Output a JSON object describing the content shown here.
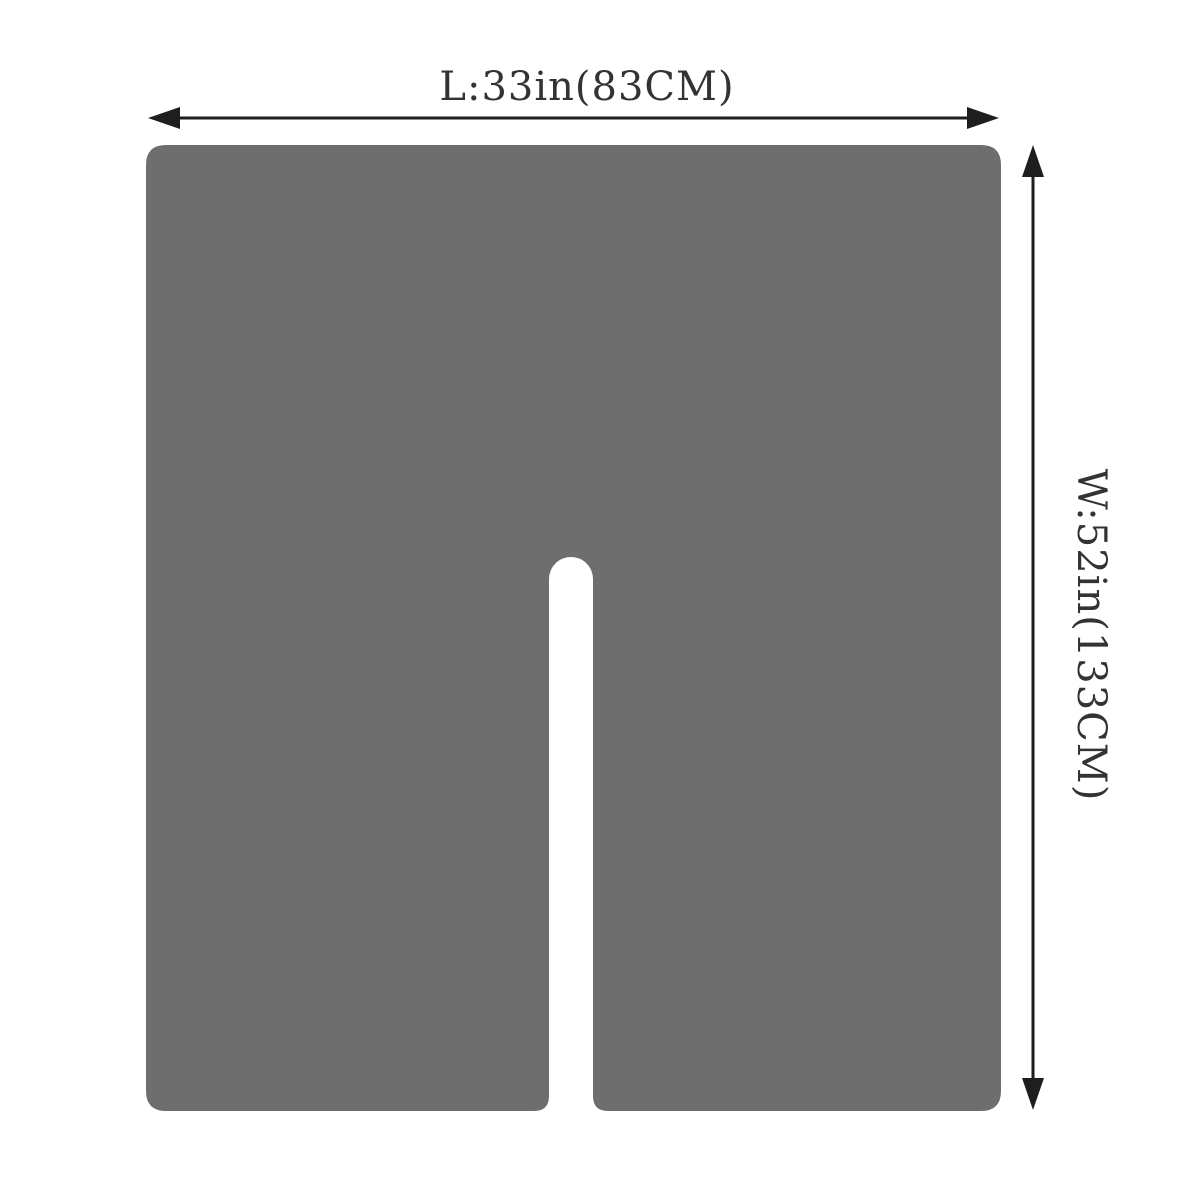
{
  "page": {
    "background_color": "#ffffff"
  },
  "diagram": {
    "shape_color": "#6E6E6E",
    "arrow_color": "#1E1E1E",
    "text_color": "#333333",
    "length_dimension": {
      "label": "L:33in(83CM)"
    },
    "width_dimension": {
      "label": "W:52in(133CM)"
    },
    "icons": {
      "length_arrow": "double-headed-horizontal-arrow",
      "width_arrow": "double-headed-vertical-arrow"
    }
  }
}
